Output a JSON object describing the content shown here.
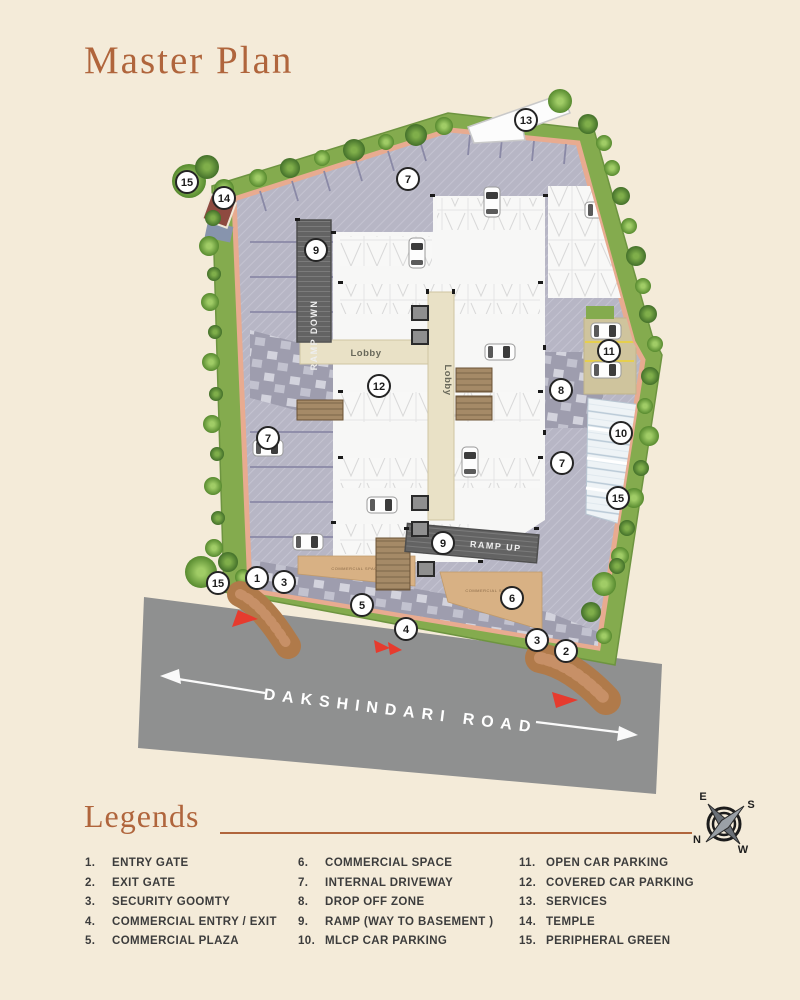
{
  "title": "Master Plan",
  "colors": {
    "background": "#f4ebd9",
    "accent": "#b0653c",
    "road_gray": "#8f9090",
    "green_band": "#84ab4e",
    "boundary_salmon": "#e8ab90",
    "driveway": "#b7b6c5",
    "commercial_tan": "#d8b184",
    "ramp_dark": "#636363",
    "gate_wood": "#b07a4a",
    "entry_triangle_red": "#e63b2e",
    "legend_text": "#3c3c3c"
  },
  "plan": {
    "road_name": "DAKSHINDARI ROAD",
    "labels": {
      "lobby_horizontal": "Lobby",
      "lobby_vertical": "Lobby",
      "ramp_down": "RAMP DOWN",
      "ramp_up": "RAMP UP",
      "commercial_space_a": "COMMERCIAL SPACE",
      "commercial_space_b": "COMMERCIAL SPACE"
    },
    "markers": [
      "15",
      "14",
      "7",
      "13",
      "9",
      "12",
      "11",
      "8",
      "10",
      "7",
      "7",
      "15",
      "9",
      "15",
      "1",
      "3",
      "5",
      "4",
      "6",
      "3",
      "2"
    ]
  },
  "compass": {
    "n": "N",
    "s": "S",
    "e": "E",
    "w": "W"
  },
  "legend": {
    "heading": "Legends",
    "columns": [
      [
        {
          "num": "1.",
          "label": "ENTRY GATE"
        },
        {
          "num": "2.",
          "label": "EXIT GATE"
        },
        {
          "num": "3.",
          "label": "SECURITY GOOMTY"
        },
        {
          "num": "4.",
          "label": "COMMERCIAL ENTRY / EXIT"
        },
        {
          "num": "5.",
          "label": "COMMERCIAL PLAZA"
        }
      ],
      [
        {
          "num": "6.",
          "label": "COMMERCIAL SPACE"
        },
        {
          "num": "7.",
          "label": "INTERNAL DRIVEWAY"
        },
        {
          "num": "8.",
          "label": "DROP OFF ZONE"
        },
        {
          "num": "9.",
          "label": "RAMP (WAY TO BASEMENT )"
        },
        {
          "num": "10.",
          "label": "MLCP CAR PARKING"
        }
      ],
      [
        {
          "num": "11.",
          "label": "OPEN CAR PARKING"
        },
        {
          "num": "12.",
          "label": "COVERED CAR PARKING"
        },
        {
          "num": "13.",
          "label": "SERVICES"
        },
        {
          "num": "14.",
          "label": "TEMPLE"
        },
        {
          "num": "15.",
          "label": "PERIPHERAL GREEN"
        }
      ]
    ]
  }
}
